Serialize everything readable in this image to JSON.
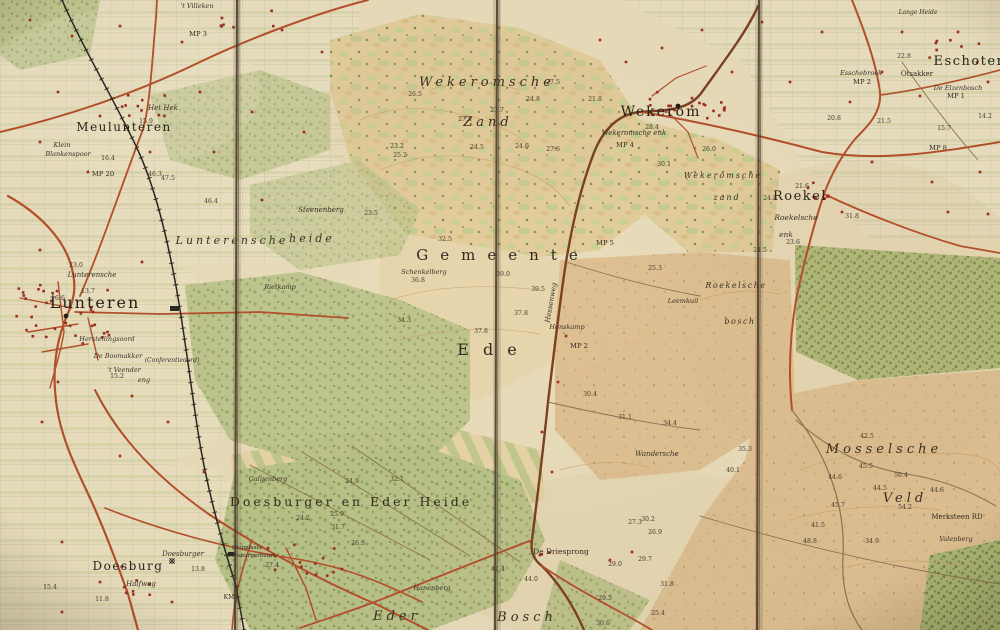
{
  "map": {
    "title_words_on_map": [
      "Gemeente",
      "Ede"
    ],
    "kind": "folded historical topographic map"
  },
  "colors": {
    "paper": "#e9dcba",
    "fields": "#eadfc0",
    "woods": "#b8c287",
    "dense_woods": "#aab873",
    "zand": "#e3cd9c",
    "heath": "#dfc092",
    "road": "#b5502b",
    "road_dark": "#7c4123",
    "track": "#8d7450",
    "rail": "#2b2620",
    "building": "#9e2f23",
    "fold": "#473829",
    "contour": "#c69a62",
    "ink": "#2e281e"
  },
  "labels": [
    {
      "t": "Meulunteren",
      "x": 124,
      "y": 131,
      "s": 12,
      "st": "town",
      "ls": 1.5
    },
    {
      "t": "Klein",
      "x": 62,
      "y": 147,
      "s": 6.5,
      "st": "farm"
    },
    {
      "t": "Blankenspoor",
      "x": 68,
      "y": 156,
      "s": 6.5,
      "st": "farm"
    },
    {
      "t": "Het Hek",
      "x": 163,
      "y": 110,
      "s": 7,
      "st": "farm"
    },
    {
      "t": "'t Villeken",
      "x": 197,
      "y": 8,
      "s": 6.5,
      "st": "farm"
    },
    {
      "t": "Lunteren",
      "x": 95,
      "y": 308,
      "s": 16,
      "st": "town",
      "ls": 2
    },
    {
      "t": "Lunterensche",
      "x": 92,
      "y": 277,
      "s": 7,
      "st": "farm"
    },
    {
      "t": "Herstellingsoord",
      "x": 107,
      "y": 341,
      "s": 6.5,
      "st": "farm"
    },
    {
      "t": "De Boomakker",
      "x": 118,
      "y": 358,
      "s": 6.5,
      "st": "farm"
    },
    {
      "t": "'t Veender",
      "x": 124,
      "y": 372,
      "s": 6.5,
      "st": "farm"
    },
    {
      "t": "eng",
      "x": 144,
      "y": 382,
      "s": 6.5,
      "st": "farm"
    },
    {
      "t": "(Conferentieoord)",
      "x": 172,
      "y": 362,
      "s": 6,
      "st": "farm"
    },
    {
      "t": "Lunterensche",
      "x": 232,
      "y": 244,
      "s": 11,
      "st": "areaIt",
      "ls": 3
    },
    {
      "t": "heide",
      "x": 312,
      "y": 242,
      "s": 11,
      "st": "areaIt",
      "ls": 3
    },
    {
      "t": "Steenenberg",
      "x": 321,
      "y": 212,
      "s": 7,
      "st": "farm"
    },
    {
      "t": "Rietkamp",
      "x": 280,
      "y": 289,
      "s": 6.5,
      "st": "farm"
    },
    {
      "t": "Wekeromsche",
      "x": 487,
      "y": 86,
      "s": 13,
      "st": "areaIt",
      "ls": 4
    },
    {
      "t": "Zand",
      "x": 488,
      "y": 126,
      "s": 13,
      "st": "areaIt",
      "ls": 4
    },
    {
      "t": "Wekerom",
      "x": 661,
      "y": 116,
      "s": 14,
      "st": "town",
      "ls": 2
    },
    {
      "t": "Wekeromsche enk",
      "x": 634,
      "y": 135,
      "s": 7,
      "st": "farm"
    },
    {
      "t": "Wekeromsche",
      "x": 723,
      "y": 178,
      "s": 8,
      "st": "areaIt",
      "ls": 2
    },
    {
      "t": "zand",
      "x": 727,
      "y": 200,
      "s": 8,
      "st": "areaIt",
      "ls": 2
    },
    {
      "t": "Roekel",
      "x": 800,
      "y": 200,
      "s": 13,
      "st": "town",
      "ls": 1.5
    },
    {
      "t": "Roekelsche",
      "x": 796,
      "y": 220,
      "s": 7.5,
      "st": "farm"
    },
    {
      "t": "enk",
      "x": 786,
      "y": 237,
      "s": 7.5,
      "st": "farm"
    },
    {
      "t": "Roekelsche",
      "x": 736,
      "y": 288,
      "s": 8,
      "st": "areaIt",
      "ls": 1.5
    },
    {
      "t": "bosch",
      "x": 740,
      "y": 324,
      "s": 8,
      "st": "areaIt",
      "ls": 1.5
    },
    {
      "t": "Leemkuil",
      "x": 683,
      "y": 303,
      "s": 6.5,
      "st": "farm"
    },
    {
      "t": "Gemeente",
      "x": 503,
      "y": 260,
      "s": 15,
      "st": "area",
      "ls": 12
    },
    {
      "t": "Ede",
      "x": 494,
      "y": 355,
      "s": 16,
      "st": "area",
      "ls": 14
    },
    {
      "t": "Schenkelberg",
      "x": 424,
      "y": 274,
      "s": 6.5,
      "st": "farm"
    },
    {
      "t": "Hessenweg",
      "x": 553,
      "y": 303,
      "s": 7,
      "st": "farm",
      "r": -80
    },
    {
      "t": "Honskamp",
      "x": 567,
      "y": 329,
      "s": 6.5,
      "st": "farm"
    },
    {
      "t": "De Driesprong",
      "x": 561,
      "y": 554,
      "s": 7.5,
      "st": "small"
    },
    {
      "t": "Doesburger en Eder Heide",
      "x": 351,
      "y": 506,
      "s": 12.5,
      "st": "area",
      "ls": 3
    },
    {
      "t": "Galgenberg",
      "x": 268,
      "y": 481,
      "s": 6.5,
      "st": "farm"
    },
    {
      "t": "Stopplaats",
      "x": 247,
      "y": 549,
      "s": 5.5,
      "st": "small"
    },
    {
      "t": "Doesburgerbuurt",
      "x": 251,
      "y": 557,
      "s": 5.5,
      "st": "small"
    },
    {
      "t": "Doesburg",
      "x": 128,
      "y": 570,
      "s": 12,
      "st": "town",
      "ls": 1.5
    },
    {
      "t": "Doesburger",
      "x": 183,
      "y": 556,
      "s": 7,
      "st": "farm"
    },
    {
      "t": "Halfweg",
      "x": 141,
      "y": 586,
      "s": 7,
      "st": "farm"
    },
    {
      "t": "Eder",
      "x": 397,
      "y": 620,
      "s": 13,
      "st": "areaIt",
      "ls": 4
    },
    {
      "t": "Bosch",
      "x": 527,
      "y": 621,
      "s": 13,
      "st": "areaIt",
      "ls": 4
    },
    {
      "t": "Hanenberg",
      "x": 432,
      "y": 590,
      "s": 6.5,
      "st": "farm"
    },
    {
      "t": "Mosselsche",
      "x": 884,
      "y": 453,
      "s": 13,
      "st": "areaIt",
      "ls": 4
    },
    {
      "t": "Veld",
      "x": 905,
      "y": 502,
      "s": 13,
      "st": "areaIt",
      "ls": 4
    },
    {
      "t": "Merksteen RD",
      "x": 957,
      "y": 519,
      "s": 7,
      "st": "small"
    },
    {
      "t": "Valenberg",
      "x": 956,
      "y": 541,
      "s": 6.5,
      "st": "farm"
    },
    {
      "t": "Eschoten",
      "x": 970,
      "y": 65,
      "s": 13,
      "st": "town",
      "ls": 1.5
    },
    {
      "t": "Esschebroek",
      "x": 861,
      "y": 75,
      "s": 6.5,
      "st": "farm"
    },
    {
      "t": "Otsakker",
      "x": 917,
      "y": 76,
      "s": 7,
      "st": "small"
    },
    {
      "t": "De Elzenbosch",
      "x": 958,
      "y": 90,
      "s": 6.5,
      "st": "farm"
    },
    {
      "t": "Wandersche",
      "x": 657,
      "y": 456,
      "s": 7,
      "st": "farm"
    },
    {
      "t": "Lange Heide",
      "x": 918,
      "y": 14,
      "s": 6,
      "st": "farm"
    },
    {
      "t": "KM",
      "x": 229,
      "y": 599,
      "s": 6,
      "st": "small"
    }
  ],
  "milestones": [
    {
      "t": "MP 20",
      "x": 103,
      "y": 176
    },
    {
      "t": "MP 3",
      "x": 198,
      "y": 36
    },
    {
      "t": "MP 4",
      "x": 625,
      "y": 147
    },
    {
      "t": "MP 5",
      "x": 605,
      "y": 245
    },
    {
      "t": "MP 2",
      "x": 579,
      "y": 348
    },
    {
      "t": "MP 2",
      "x": 862,
      "y": 84
    },
    {
      "t": "MP 1",
      "x": 956,
      "y": 98
    },
    {
      "t": "MP 8",
      "x": 938,
      "y": 150
    }
  ],
  "spot_heights": [
    {
      "v": "16.4",
      "x": 108,
      "y": 160
    },
    {
      "v": "15.9",
      "x": 146,
      "y": 123
    },
    {
      "v": "46.3",
      "x": 155,
      "y": 176
    },
    {
      "v": "47.5",
      "x": 168,
      "y": 180
    },
    {
      "v": "23.0",
      "x": 76,
      "y": 267
    },
    {
      "v": "13.7",
      "x": 88,
      "y": 293
    },
    {
      "v": "16.6",
      "x": 58,
      "y": 300
    },
    {
      "v": "15.2",
      "x": 117,
      "y": 378
    },
    {
      "v": "46.4",
      "x": 211,
      "y": 203
    },
    {
      "v": "23.5",
      "x": 371,
      "y": 215
    },
    {
      "v": "26.5",
      "x": 415,
      "y": 96
    },
    {
      "v": "27.5",
      "x": 553,
      "y": 84
    },
    {
      "v": "24.8",
      "x": 533,
      "y": 101
    },
    {
      "v": "21.8",
      "x": 595,
      "y": 101
    },
    {
      "v": "23.7",
      "x": 497,
      "y": 112
    },
    {
      "v": "27.4",
      "x": 465,
      "y": 121
    },
    {
      "v": "23.2",
      "x": 397,
      "y": 148
    },
    {
      "v": "25.2",
      "x": 400,
      "y": 157
    },
    {
      "v": "24.5",
      "x": 477,
      "y": 149
    },
    {
      "v": "24.6",
      "x": 522,
      "y": 148
    },
    {
      "v": "27.6",
      "x": 553,
      "y": 151
    },
    {
      "v": "32.5",
      "x": 445,
      "y": 241
    },
    {
      "v": "36.8",
      "x": 418,
      "y": 282
    },
    {
      "v": "39.0",
      "x": 503,
      "y": 276
    },
    {
      "v": "39.5",
      "x": 538,
      "y": 291
    },
    {
      "v": "34.3",
      "x": 404,
      "y": 322
    },
    {
      "v": "37.8",
      "x": 521,
      "y": 315
    },
    {
      "v": "37.8",
      "x": 481,
      "y": 333
    },
    {
      "v": "28.4",
      "x": 652,
      "y": 129
    },
    {
      "v": "26.0",
      "x": 709,
      "y": 151
    },
    {
      "v": "30.1",
      "x": 664,
      "y": 166
    },
    {
      "v": "20.8",
      "x": 834,
      "y": 120
    },
    {
      "v": "21.5",
      "x": 884,
      "y": 123
    },
    {
      "v": "22.8",
      "x": 904,
      "y": 58
    },
    {
      "v": "14.2",
      "x": 985,
      "y": 118
    },
    {
      "v": "15.7",
      "x": 944,
      "y": 130
    },
    {
      "v": "21.6",
      "x": 802,
      "y": 188
    },
    {
      "v": "24.8",
      "x": 770,
      "y": 200
    },
    {
      "v": "31.8",
      "x": 852,
      "y": 218
    },
    {
      "v": "23.6",
      "x": 793,
      "y": 244
    },
    {
      "v": "24.5",
      "x": 760,
      "y": 252
    },
    {
      "v": "25.3",
      "x": 655,
      "y": 270
    },
    {
      "v": "30.4",
      "x": 590,
      "y": 396
    },
    {
      "v": "31.1",
      "x": 625,
      "y": 419
    },
    {
      "v": "34.4",
      "x": 670,
      "y": 425
    },
    {
      "v": "35.3",
      "x": 745,
      "y": 451
    },
    {
      "v": "40.1",
      "x": 733,
      "y": 472
    },
    {
      "v": "42.5",
      "x": 867,
      "y": 438
    },
    {
      "v": "45.5",
      "x": 866,
      "y": 468
    },
    {
      "v": "44.6",
      "x": 835,
      "y": 479
    },
    {
      "v": "50.4",
      "x": 901,
      "y": 477
    },
    {
      "v": "44.5",
      "x": 880,
      "y": 490
    },
    {
      "v": "44.6",
      "x": 937,
      "y": 492
    },
    {
      "v": "45.7",
      "x": 838,
      "y": 507
    },
    {
      "v": "54.2",
      "x": 905,
      "y": 509
    },
    {
      "v": "41.5",
      "x": 818,
      "y": 527
    },
    {
      "v": "48.8",
      "x": 810,
      "y": 543
    },
    {
      "v": "34.9",
      "x": 872,
      "y": 543
    },
    {
      "v": "41.4",
      "x": 498,
      "y": 571
    },
    {
      "v": "44.0",
      "x": 531,
      "y": 581
    },
    {
      "v": "30.2",
      "x": 648,
      "y": 521
    },
    {
      "v": "27.3",
      "x": 635,
      "y": 524
    },
    {
      "v": "26.9",
      "x": 655,
      "y": 534
    },
    {
      "v": "29.7",
      "x": 645,
      "y": 561
    },
    {
      "v": "29.0",
      "x": 615,
      "y": 566
    },
    {
      "v": "29.5",
      "x": 605,
      "y": 600
    },
    {
      "v": "25.4",
      "x": 658,
      "y": 615
    },
    {
      "v": "31.8",
      "x": 667,
      "y": 586
    },
    {
      "v": "30.6",
      "x": 603,
      "y": 625
    },
    {
      "v": "24.9",
      "x": 352,
      "y": 483
    },
    {
      "v": "32.1",
      "x": 397,
      "y": 481
    },
    {
      "v": "24.2",
      "x": 303,
      "y": 520
    },
    {
      "v": "25.9",
      "x": 337,
      "y": 516
    },
    {
      "v": "31.7",
      "x": 338,
      "y": 529
    },
    {
      "v": "26.3",
      "x": 358,
      "y": 545
    },
    {
      "v": "27.4",
      "x": 272,
      "y": 567
    },
    {
      "v": "15.4",
      "x": 50,
      "y": 589
    },
    {
      "v": "13.8",
      "x": 198,
      "y": 571
    },
    {
      "v": "11.8",
      "x": 102,
      "y": 601
    }
  ],
  "symbols": [
    {
      "name": "church-icon",
      "x": 66,
      "y": 316
    },
    {
      "name": "church-icon",
      "x": 678,
      "y": 106
    },
    {
      "name": "windmill-icon",
      "x": 172,
      "y": 561
    }
  ]
}
